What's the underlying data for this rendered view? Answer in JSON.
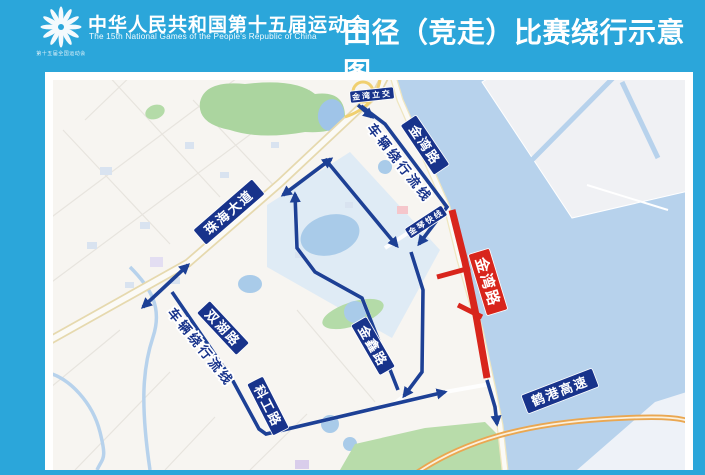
{
  "header": {
    "emblem_caption": "第十五届全国运动会",
    "title_cn": "中华人民共和国第十五届运动会",
    "title_en": "The 15th National Games of the People's Republic of China",
    "page_title": "田径（竞走）比赛绕行示意图"
  },
  "colors": {
    "poster_bg": "#2ba6da",
    "label_navy": "#18338b",
    "route_blue": "#1d4095",
    "closed_red": "#d8251c",
    "water": "#b7d2ec",
    "land": "#f7f5f1",
    "island": "#f0f1f4",
    "park_green": "#abd59f",
    "highway_orange": "#eaa751"
  },
  "map": {
    "closed_road": {
      "name": "jinwan-road-closed-segment",
      "color": "#d8251c",
      "main": [
        [
          407,
          138
        ],
        [
          420,
          190
        ],
        [
          431,
          243
        ],
        [
          442,
          306
        ]
      ],
      "stubs": [
        [
          [
            425,
            196
          ],
          [
            392,
            205
          ]
        ],
        [
          [
            437,
            245
          ],
          [
            413,
            233
          ]
        ]
      ]
    },
    "routes": [
      {
        "id": "interchange-exit",
        "pts": [
          [
            313,
            33
          ],
          [
            327,
            45
          ]
        ],
        "arrows": "end"
      },
      {
        "id": "coast-road-detour",
        "pts": [
          [
            316,
            34
          ],
          [
            340,
            52
          ],
          [
            402,
            135
          ],
          [
            374,
            172
          ]
        ],
        "arrows": "end"
      },
      {
        "id": "avenue-to-junction",
        "pts": [
          [
            280,
            87
          ],
          [
            352,
            174
          ]
        ],
        "arrows": "end"
      },
      {
        "id": "inland-parallel-south",
        "pts": [
          [
            366,
            180
          ],
          [
            378,
            218
          ],
          [
            377,
            300
          ],
          [
            359,
            324
          ]
        ],
        "arrows": "end"
      },
      {
        "id": "shuanghu-kegong-loop",
        "pts": [
          [
            127,
            220
          ],
          [
            188,
            309
          ],
          [
            214,
            357
          ],
          [
            221,
            362
          ],
          [
            400,
            320
          ]
        ],
        "arrows": "end"
      },
      {
        "id": "zhuhai-avenue-two-way",
        "pts": [
          [
            98,
            235
          ],
          [
            143,
            193
          ]
        ],
        "arrows": "both"
      },
      {
        "id": "zhuhai-avenue-two-way-2",
        "pts": [
          [
            238,
            123
          ],
          [
            286,
            87
          ]
        ],
        "arrows": "both"
      },
      {
        "id": "jinxin-northbound",
        "pts": [
          [
            353,
            318
          ],
          [
            317,
            226
          ],
          [
            270,
            200
          ],
          [
            252,
            176
          ],
          [
            250,
            122
          ]
        ],
        "arrows": "end"
      },
      {
        "id": "south-exit-to-hegang",
        "pts": [
          [
            442,
            308
          ],
          [
            450,
            335
          ],
          [
            452,
            352
          ]
        ],
        "arrows": "end"
      }
    ],
    "road_labels": [
      {
        "id": "zhuhai-avenue",
        "text": "珠海大道",
        "cx": 184,
        "cy": 140,
        "rot": -41,
        "w": 78,
        "h": 20,
        "bg": "#18338b",
        "fs": 13
      },
      {
        "id": "jinwan-road",
        "text": "金湾路",
        "cx": 380,
        "cy": 73,
        "rot": 56,
        "w": 60,
        "h": 19,
        "bg": "#18338b",
        "fs": 13
      },
      {
        "id": "jinwan-interchange",
        "text": "金湾立交",
        "cx": 327,
        "cy": 23,
        "rot": -6,
        "w": 44,
        "h": 12,
        "bg": "#18338b",
        "fs": 8
      },
      {
        "id": "jinqin-expressline",
        "text": "金琴快线",
        "cx": 381,
        "cy": 150,
        "rot": -33,
        "w": 44,
        "h": 12,
        "bg": "#18338b",
        "fs": 8
      },
      {
        "id": "shuanghu-road",
        "text": "双湖路",
        "cx": 178,
        "cy": 256,
        "rot": 47,
        "w": 58,
        "h": 18,
        "bg": "#18338b",
        "fs": 13
      },
      {
        "id": "kegong-road",
        "text": "科工路",
        "cx": 223,
        "cy": 334,
        "rot": 63,
        "w": 58,
        "h": 18,
        "bg": "#18338b",
        "fs": 13
      },
      {
        "id": "jinxin-road",
        "text": "金鑫路",
        "cx": 328,
        "cy": 274,
        "rot": 60,
        "w": 58,
        "h": 18,
        "bg": "#18338b",
        "fs": 13
      },
      {
        "id": "hegang-expressway",
        "text": "鹤港高速",
        "cx": 515,
        "cy": 319,
        "rot": -21,
        "w": 76,
        "h": 20,
        "bg": "#18338b",
        "fs": 13
      },
      {
        "id": "jinwan-road-closed",
        "text": "金湾路",
        "cx": 443,
        "cy": 210,
        "rot": 73,
        "w": 64,
        "h": 22,
        "bg": "#d8251c",
        "fs": 15
      }
    ],
    "flow_labels": [
      {
        "id": "detour-flow-1",
        "text": "车辆绕行流线",
        "cx": 355,
        "cy": 91,
        "rot": 52,
        "fs": 13
      },
      {
        "id": "detour-flow-2",
        "text": "车辆绕行流线",
        "cx": 156,
        "cy": 275,
        "rot": 51,
        "fs": 13
      }
    ]
  }
}
